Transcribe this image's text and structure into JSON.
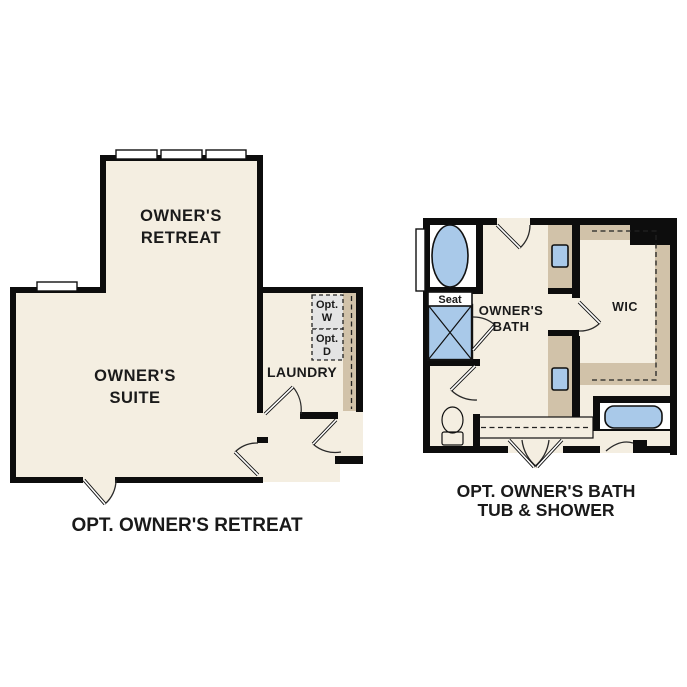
{
  "page": {
    "background": "#ffffff"
  },
  "colors": {
    "wall": "#0d0d0d",
    "floor": "#f4eee1",
    "counter": "#d1c2a9",
    "fixture_blue": "#a9c9e9",
    "appliance_gray": "#e4e4e4",
    "fixture_white": "#ffffff",
    "label": "#1a1a1a"
  },
  "left_plan": {
    "caption": "OPT. OWNER'S RETREAT",
    "rooms": {
      "retreat_line1": "OWNER'S",
      "retreat_line2": "RETREAT",
      "suite_line1": "OWNER'S",
      "suite_line2": "SUITE",
      "laundry": "LAUNDRY"
    },
    "appliances": {
      "washer_line1": "Opt.",
      "washer_line2": "W",
      "dryer_line1": "Opt.",
      "dryer_line2": "D"
    }
  },
  "right_plan": {
    "caption_line1": "OPT. OWNER'S BATH",
    "caption_line2": "TUB & SHOWER",
    "rooms": {
      "bath_line1": "OWNER'S",
      "bath_line2": "BATH",
      "wic": "WIC",
      "shower_seat": "Seat"
    }
  }
}
